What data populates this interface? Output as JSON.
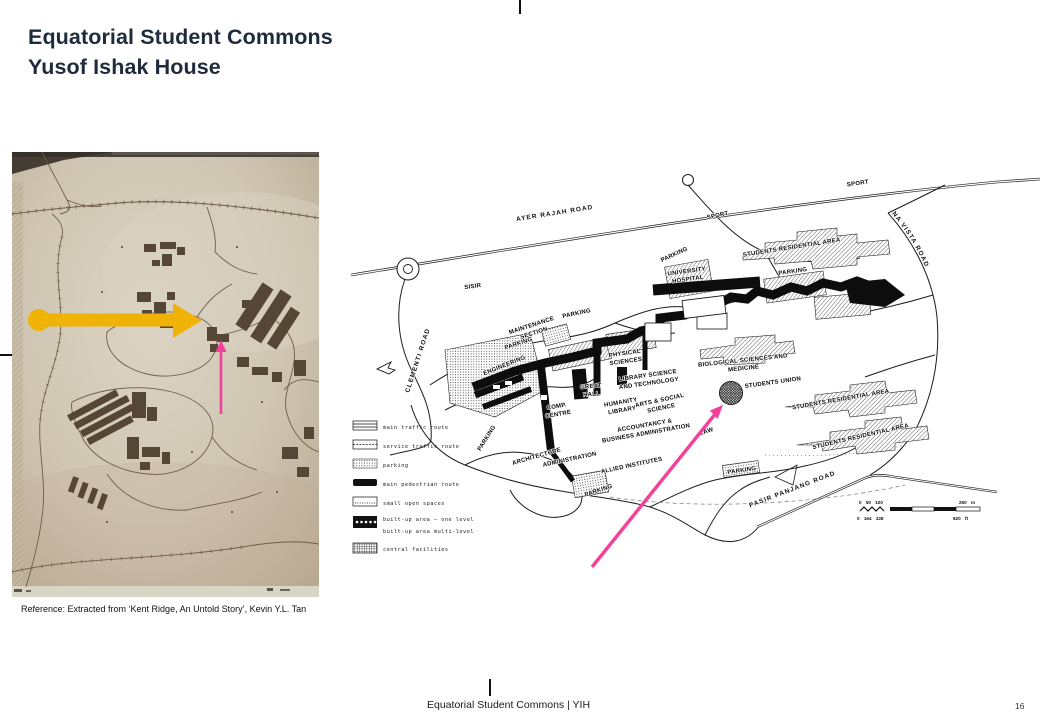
{
  "slide": {
    "title_line1": "Equatorial Student Commons",
    "title_line2": "Yusof Ishak House",
    "reference": "Reference: Extracted from ‘Kent Ridge, An Untold Story’, Kevin Y.L. Tan",
    "footer": "Equatorial Student Commons | YIH",
    "page_number": "16"
  },
  "colors": {
    "title_text": "#1f2b3c",
    "highlight_yellow": "#EEB306",
    "highlight_pink": "#F43F9B",
    "left_map_paper": "#d2c8b7",
    "left_map_ink": "#5c4b38"
  },
  "right_map": {
    "labels": {
      "ayer_rajah_road": "AYER RAJAH ROAD",
      "sisir": "SISIR",
      "clementi_road": "CLEMENTI ROAD",
      "sport_1": "SPORT",
      "sport_2": "SPORT",
      "south_buona_vista_road": "SOUTH BUONA VISTA ROAD",
      "pasir_panjang_road": "PASIR PANJANG ROAD",
      "maintenance_section": [
        "MAINTENANCE",
        "SECTION"
      ],
      "engineering": "ENGINEERING",
      "university_hospital": [
        "UNIVERSITY",
        "HOSPITAL"
      ],
      "physical_sciences": [
        "PHYSICAL",
        "SCIENCES"
      ],
      "library_science_technology": [
        "LIBRARY SCIENCE",
        "AND TECHNOLOGY"
      ],
      "biological_sciences_medicine": [
        "BIOLOGICAL SCIENCES AND",
        "MEDICINE"
      ],
      "great_hall": [
        "GREAT",
        "HALL"
      ],
      "comp_centre": [
        "COMP.",
        "CENTRE"
      ],
      "humanity_library": [
        "HUMANITY",
        "LIBRARY"
      ],
      "arts_social_science": [
        "ARTS & SOCIAL",
        "SCIENCE"
      ],
      "accountancy_business": [
        "ACCOUNTANCY &",
        "BUSINESS ADMINISTRATION"
      ],
      "law": "LAW",
      "students_union": "STUDENTS UNION",
      "architecture": "ARCHITECTURE",
      "administration": "ADMINISTRATION",
      "allied_institutes": "ALLIED INSTITUTES",
      "students_residential_1": "STUDENTS RESIDENTIAL AREA",
      "students_residential_2": "STUDENTS RESIDENTIAL AREA",
      "students_residential_3": "STUDENTS RESIDENTIAL AREA",
      "parking_top": "PARKING",
      "parking_maintenance": "PARKING",
      "parking_service": "PARKING",
      "parking_mid": "PARKING",
      "parking_diagonal": "PARKING",
      "parking_allied": "PARKING",
      "parking_right": "PARKING"
    },
    "legend": [
      "main traffic route",
      "service traffic route",
      "parking",
      "main pedestrian route",
      "small open spaces",
      "built-up area – one level",
      "built-up area   multi-level",
      "central facilities"
    ],
    "scale": {
      "metric_ticks": "0 50 100",
      "metric_end": "250 m",
      "imperial_ticks": "0 164 328",
      "imperial_end": "820 ft"
    }
  }
}
